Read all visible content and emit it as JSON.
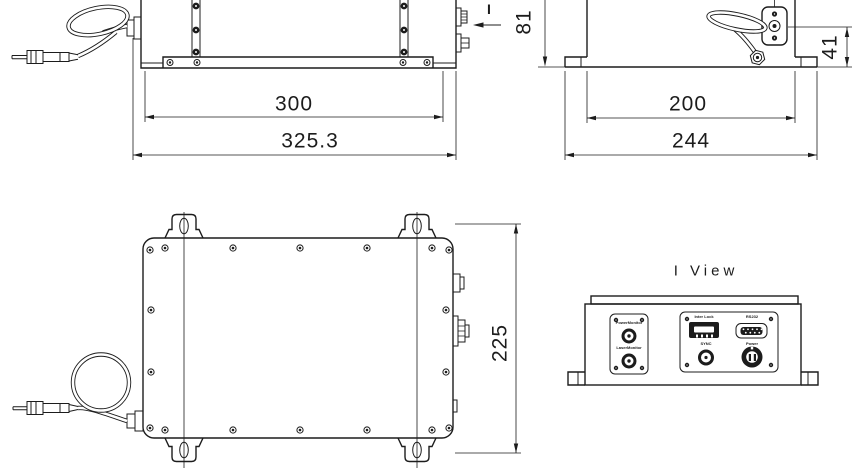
{
  "drawing": {
    "view_title": "I View",
    "section_arrow_label": "I",
    "dimensions": {
      "side_view": {
        "body_width": "300",
        "overall_width": "325.3"
      },
      "front_view": {
        "overall_height": "81",
        "fiber_exit_height": "41",
        "body_width": "200",
        "overall_width": "244"
      },
      "top_view": {
        "overall_depth": "225"
      }
    },
    "rear_panel": {
      "monitor_plate": {
        "top_label": "PowerMonitor",
        "bottom_label": "LaserMonitor"
      },
      "io_plate": {
        "interlock_label": "Inter Lock",
        "rs232_label": "RS232",
        "sync_label": "SYNC",
        "power_label": "Power"
      }
    },
    "line_color": "#1c1c1c"
  }
}
